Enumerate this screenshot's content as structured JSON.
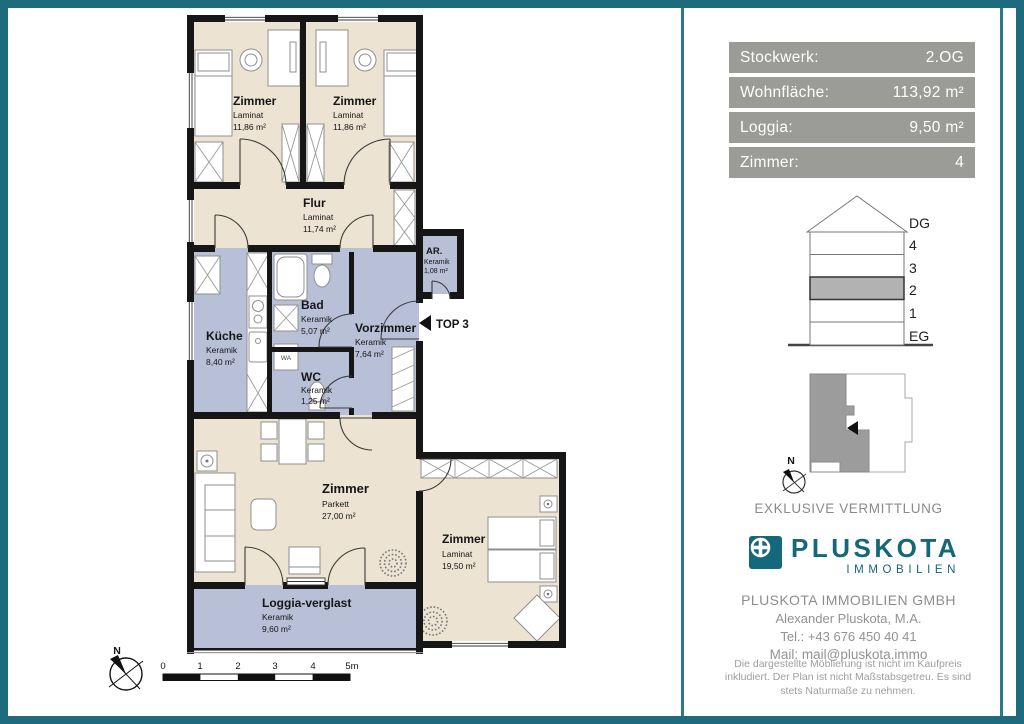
{
  "colors": {
    "frame_teal": "#1e6b7d",
    "info_box_gray": "#9b9b97",
    "laminat_parkett_floor": "#ece3d2",
    "keramik_floor": "#b8c0d8",
    "logo_teal": "#15677b",
    "highlight_gray": "#b2b2b2"
  },
  "info_panel": {
    "rows": [
      {
        "label": "Stockwerk:",
        "value": "2.OG"
      },
      {
        "label": "Wohnfläche:",
        "value": "113,92 m²"
      },
      {
        "label": "Loggia:",
        "value": "9,50 m²"
      },
      {
        "label": "Zimmer:",
        "value": "4"
      }
    ]
  },
  "building_diagram": {
    "floors": [
      "DG",
      "4",
      "3",
      "2",
      "1",
      "EG"
    ],
    "highlighted_floor": "2"
  },
  "site_plan": {
    "north_label": "N"
  },
  "texts": {
    "exclusive": "EXKLUSIVE VERMITTLUNG"
  },
  "logo": {
    "name": "PLUSKOTA",
    "subtitle": "IMMOBILIEN"
  },
  "contact": {
    "company": "PLUSKOTA IMMOBILIEN GMBH",
    "person": "Alexander Pluskota, M.A.",
    "tel": "Tel.: +43 676 450 40 41",
    "mail": "Mail: mail@pluskota.immo"
  },
  "disclaimer": "Die dargestellte Möblierung ist nicht im Kaufpreis inkludiert. Der Plan ist nicht Maßstabsgetreu. Es sind stets Naturmaße zu nehmen.",
  "floor_plan": {
    "unit_label": "TOP 3",
    "washer_label": "WA",
    "north_label": "N",
    "scale_ticks": [
      "0",
      "1",
      "2",
      "3",
      "4",
      "5m"
    ],
    "rooms": [
      {
        "name": "Zimmer",
        "material": "Laminat",
        "area": "11,86 m²"
      },
      {
        "name": "Zimmer",
        "material": "Laminat",
        "area": "11,86 m²"
      },
      {
        "name": "Flur",
        "material": "Laminat",
        "area": "11,74 m²"
      },
      {
        "name": "AR.",
        "material": "Keramik",
        "area": "1,08 m²"
      },
      {
        "name": "Küche",
        "material": "Keramik",
        "area": "8,40 m²"
      },
      {
        "name": "Bad",
        "material": "Keramik",
        "area": "5,07 m²"
      },
      {
        "name": "WC",
        "material": "Keramik",
        "area": "1,25 m²"
      },
      {
        "name": "Vorzimmer",
        "material": "Keramik",
        "area": "7,64 m²"
      },
      {
        "name": "Zimmer",
        "material": "Parkett",
        "area": "27,00 m²"
      },
      {
        "name": "Zimmer",
        "material": "Laminat",
        "area": "19,50 m²"
      },
      {
        "name": "Loggia-verglast",
        "material": "Keramik",
        "area": "9,60 m²"
      }
    ]
  }
}
